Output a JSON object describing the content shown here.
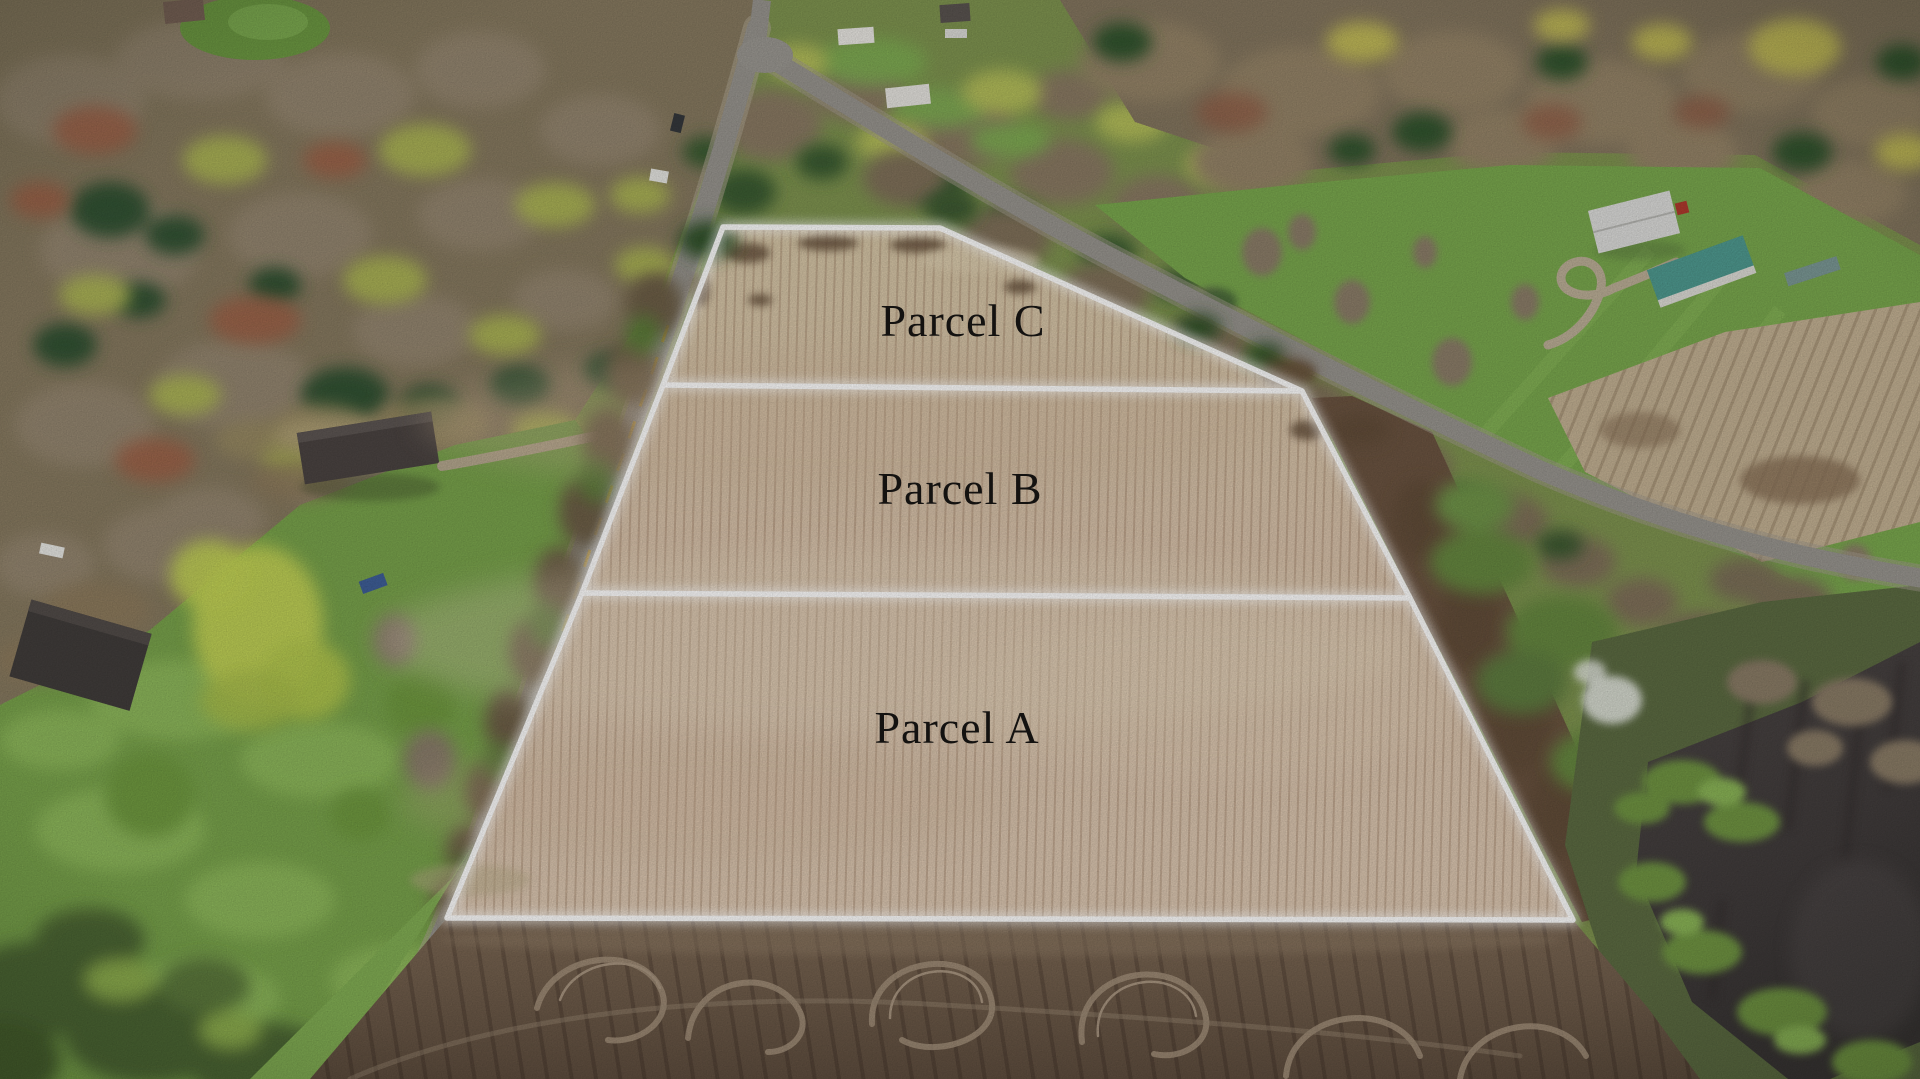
{
  "parcels": [
    {
      "id": "parcel-c",
      "label": "Parcel C"
    },
    {
      "id": "parcel-b",
      "label": "Parcel B"
    },
    {
      "id": "parcel-a",
      "label": "Parcel A"
    }
  ],
  "overlay": {
    "boundary_color": "#ffffff",
    "label_color": "#181614"
  },
  "palette": {
    "field_tan": "#d8c3ab",
    "plowed_soil": "#77614d",
    "grass_green": "#7aa84e",
    "road_gray": "#98958f",
    "pond_dark": "#454040",
    "teal_roof": "#4f9a90",
    "white_building": "#dcdcda"
  }
}
